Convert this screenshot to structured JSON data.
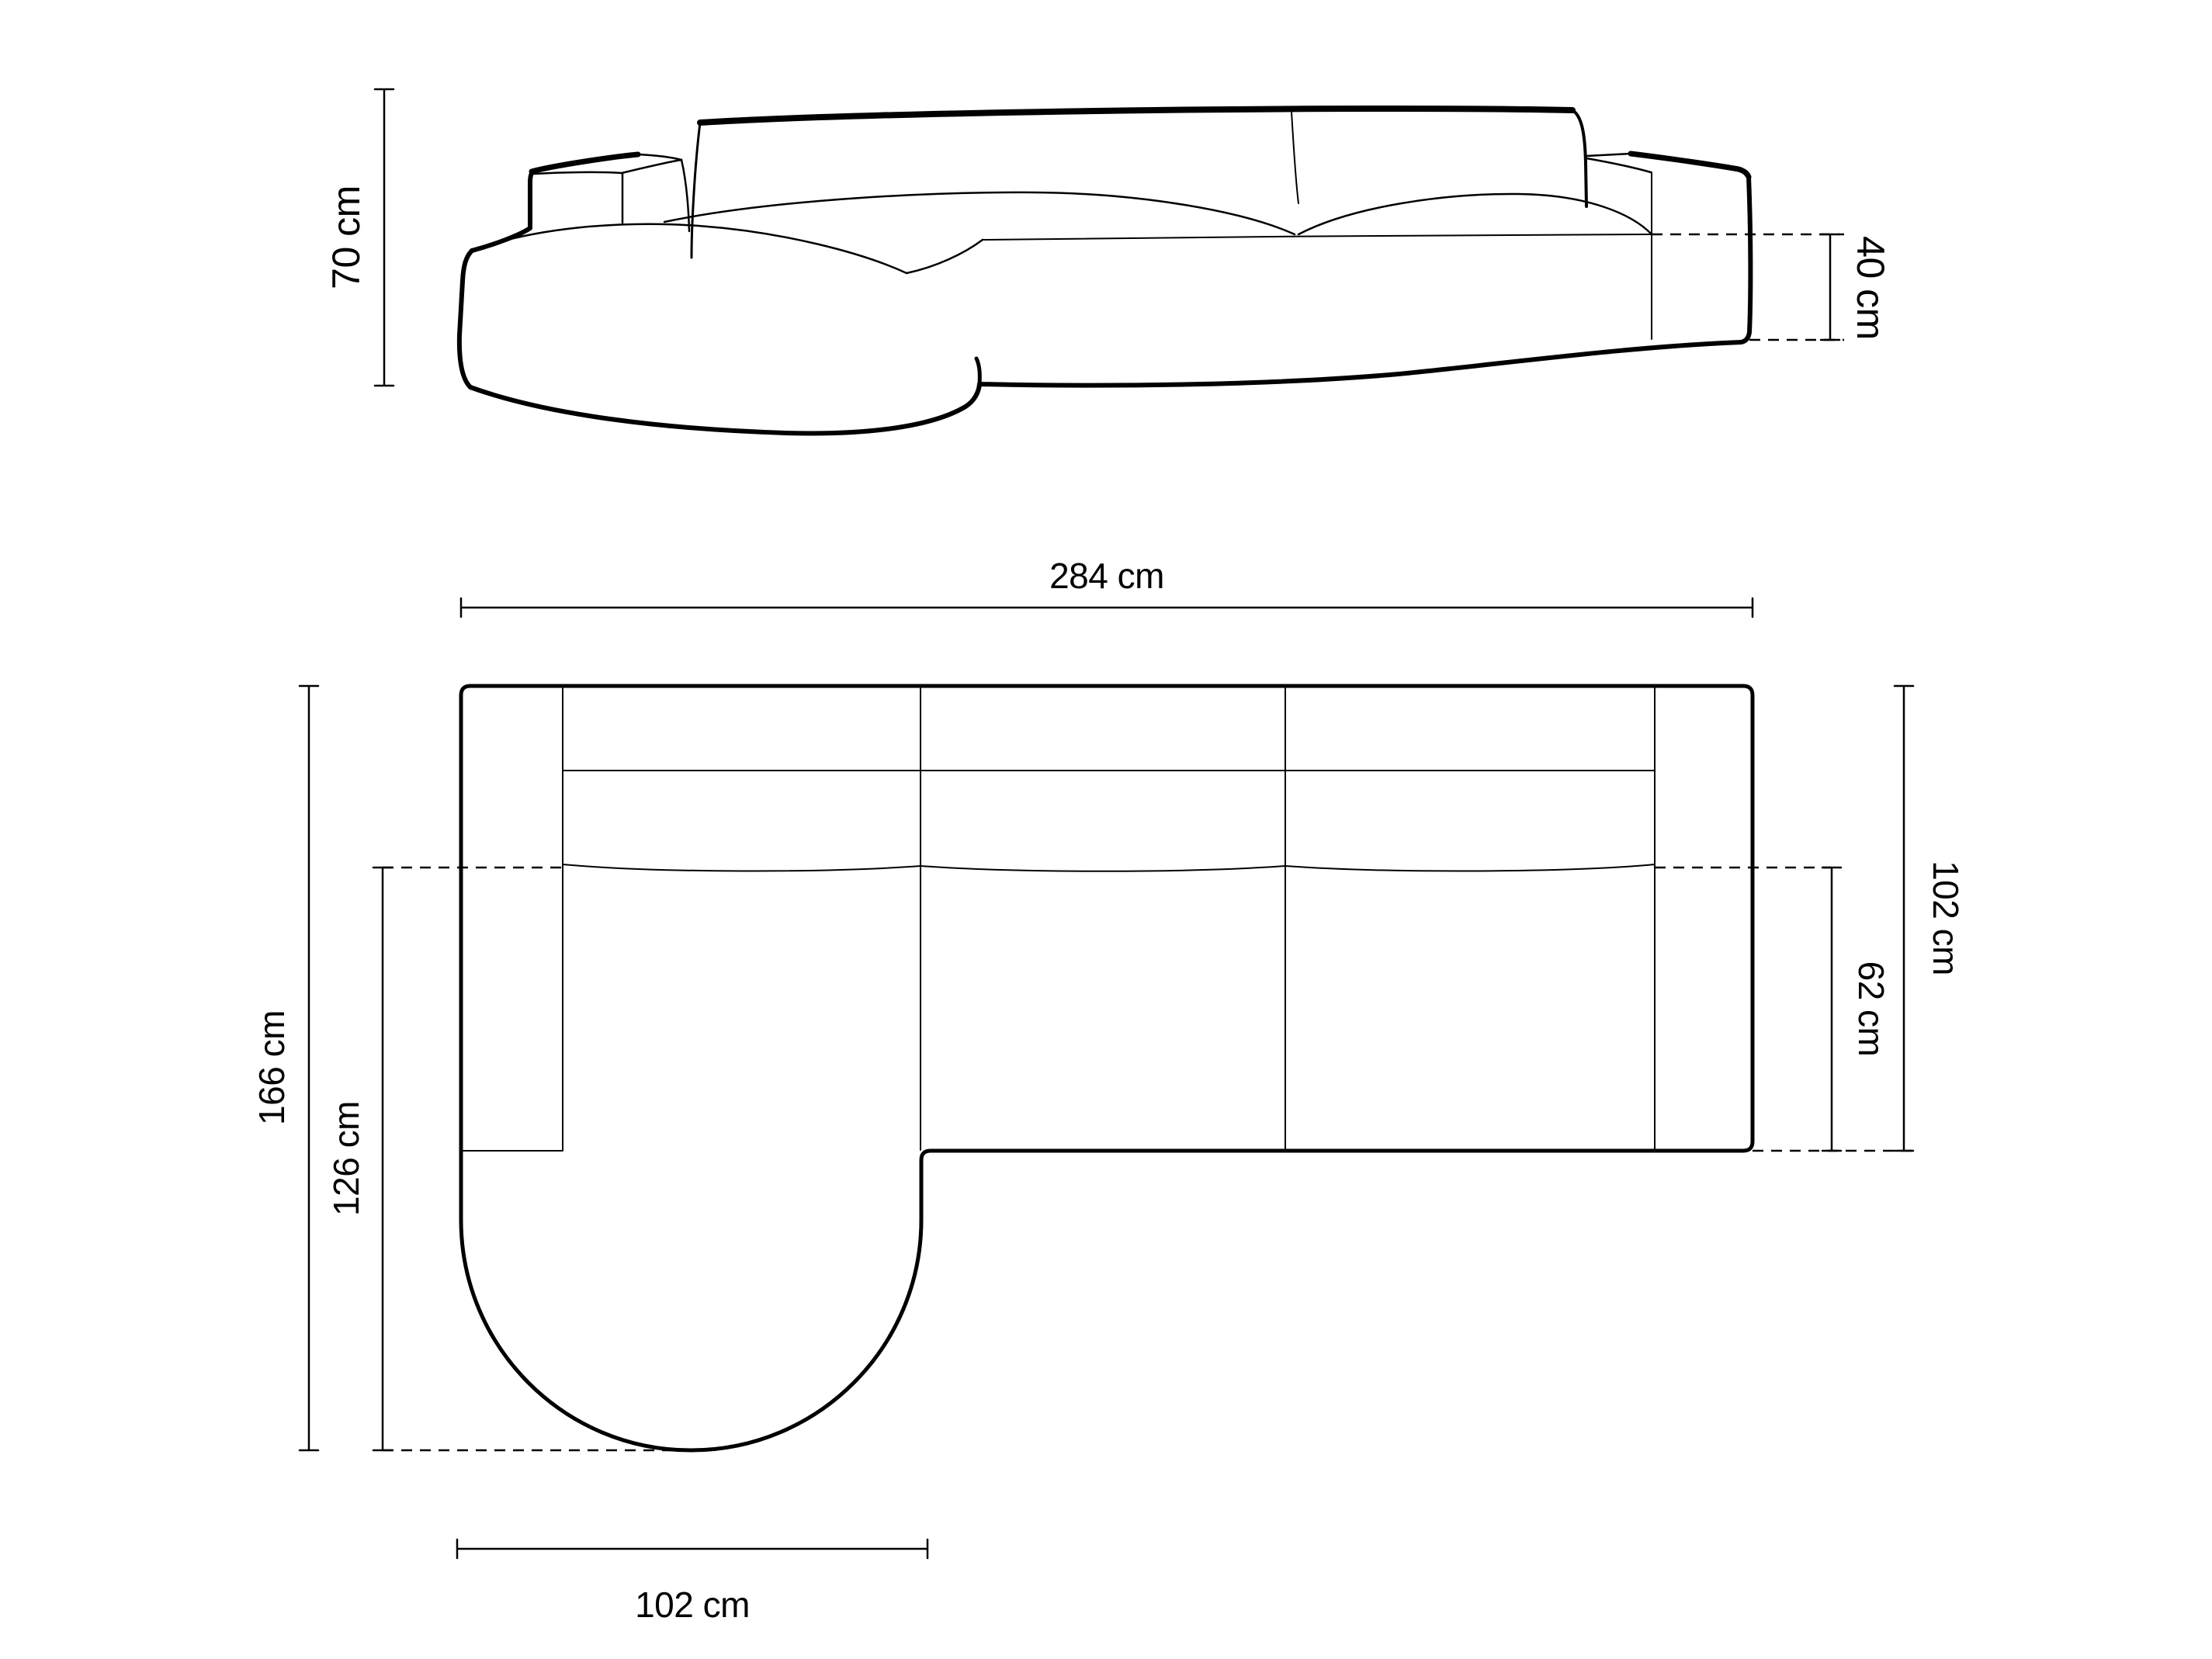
{
  "background_color": "#ffffff",
  "line_color": "#000000",
  "front_view": {
    "height_label": "70 cm",
    "seat_height_label": "40 cm"
  },
  "plan_view": {
    "width_label": "284 cm",
    "total_depth_label": "166 cm",
    "chaise_depth_label": "126 cm",
    "body_depth_label": "102 cm",
    "seat_depth_label": "62 cm",
    "chaise_width_label": "102 cm"
  }
}
